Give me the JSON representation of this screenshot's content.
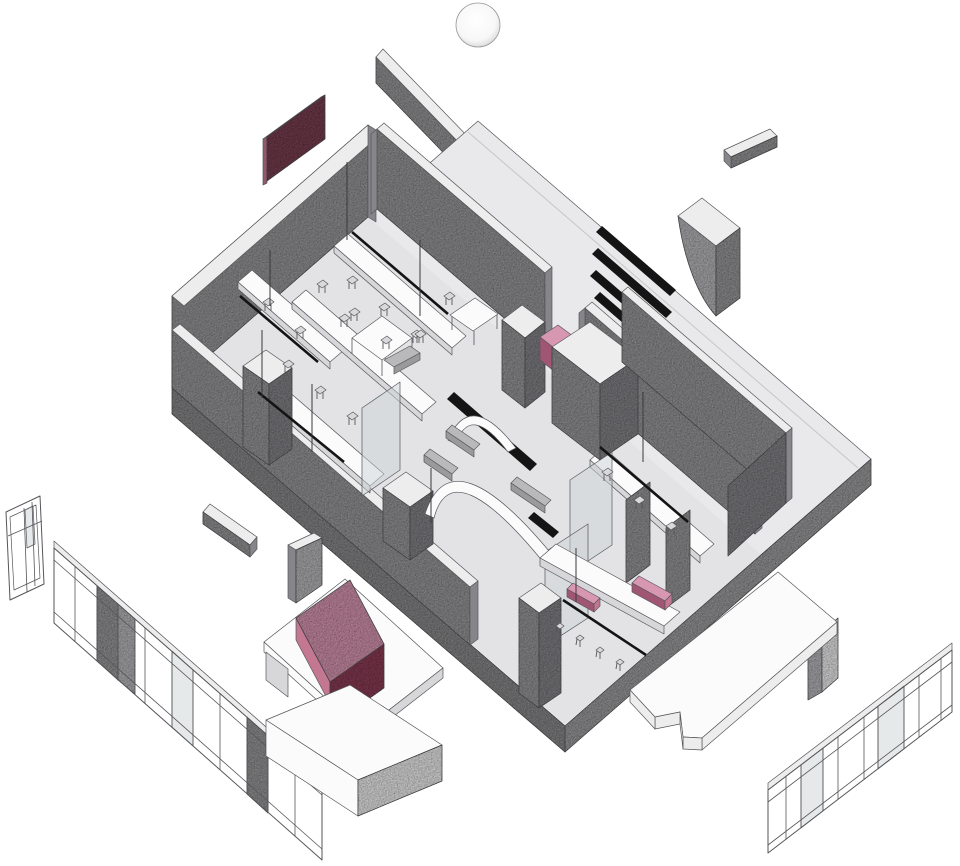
{
  "meta": {
    "description": "Exploded axonometric diagram of an interior floor plan with perimeter glazing panels, pink accent furniture and ceiling slats"
  },
  "palette": {
    "paper": "#ffffff",
    "ink": "#56565a",
    "floor": "#e9e9eb",
    "floor_inner": "#e3e3e5",
    "edge": "#9f9fa1",
    "edge_dark": "#8b8b8d",
    "wall": "#9a9a9c",
    "wall_dark": "#86868a",
    "wall_light": "#b9b9bc",
    "top_light": "#ededee",
    "white": "#fbfbfc",
    "shade": "#d7d7d9",
    "glass": "#ced3d6",
    "black": "#141414",
    "maroon": "#7b4253",
    "maroon_edge": "#93596a",
    "pink_top": "#d897b1",
    "pink_mid": "#c47791",
    "pink_dark": "#a05672",
    "pink_deep": "#8e4059",
    "chair": "#d9d9db"
  },
  "parts": [
    "sun-circle",
    "exploded-lintel-beam",
    "maroon-acoustic-panel",
    "main-floor-slab",
    "nw-perimeter-wall",
    "sw-perimeter-wall",
    "north-interior-wall",
    "work-counters",
    "ceiling-slats",
    "curved-concrete-volume",
    "floating-bar",
    "casework-and-pink-cube",
    "right-partition-walls",
    "glass-panels",
    "structural-pillars",
    "curved-wall-screens",
    "south-counter-with-pink-bars",
    "exploded-window-unit",
    "exploded-curtain-wall-left",
    "exploded-beam",
    "exploded-panel",
    "console-table-with-pink-box",
    "exploded-table-right",
    "exploded-curtain-wall-right"
  ]
}
